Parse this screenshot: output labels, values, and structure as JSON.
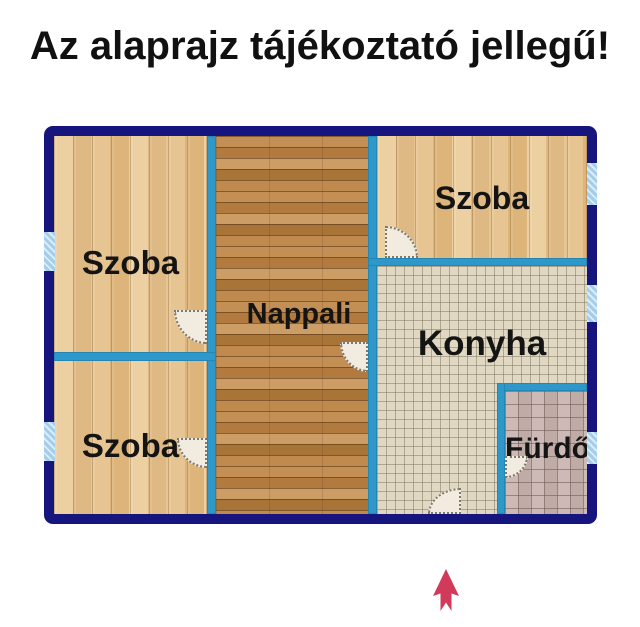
{
  "title": "Az alaprajz tájékoztató jellegű!",
  "rooms": {
    "szoba_left_top": "Szoba",
    "szoba_left_bottom": "Szoba",
    "szoba_right_top": "Szoba",
    "nappali": "Nappali",
    "konyha": "Konyha",
    "furdo": "Fürdő"
  },
  "colors": {
    "outer_wall": "#15157d",
    "inner_wall": "#2d98c9",
    "window_glass": "#aed3ee",
    "door": "#f2ebdf",
    "north_arrow": "#d23a5a",
    "title_text": "#111111",
    "label_text": "#141414"
  },
  "icons": {
    "north_arrow": "north-arrow"
  }
}
